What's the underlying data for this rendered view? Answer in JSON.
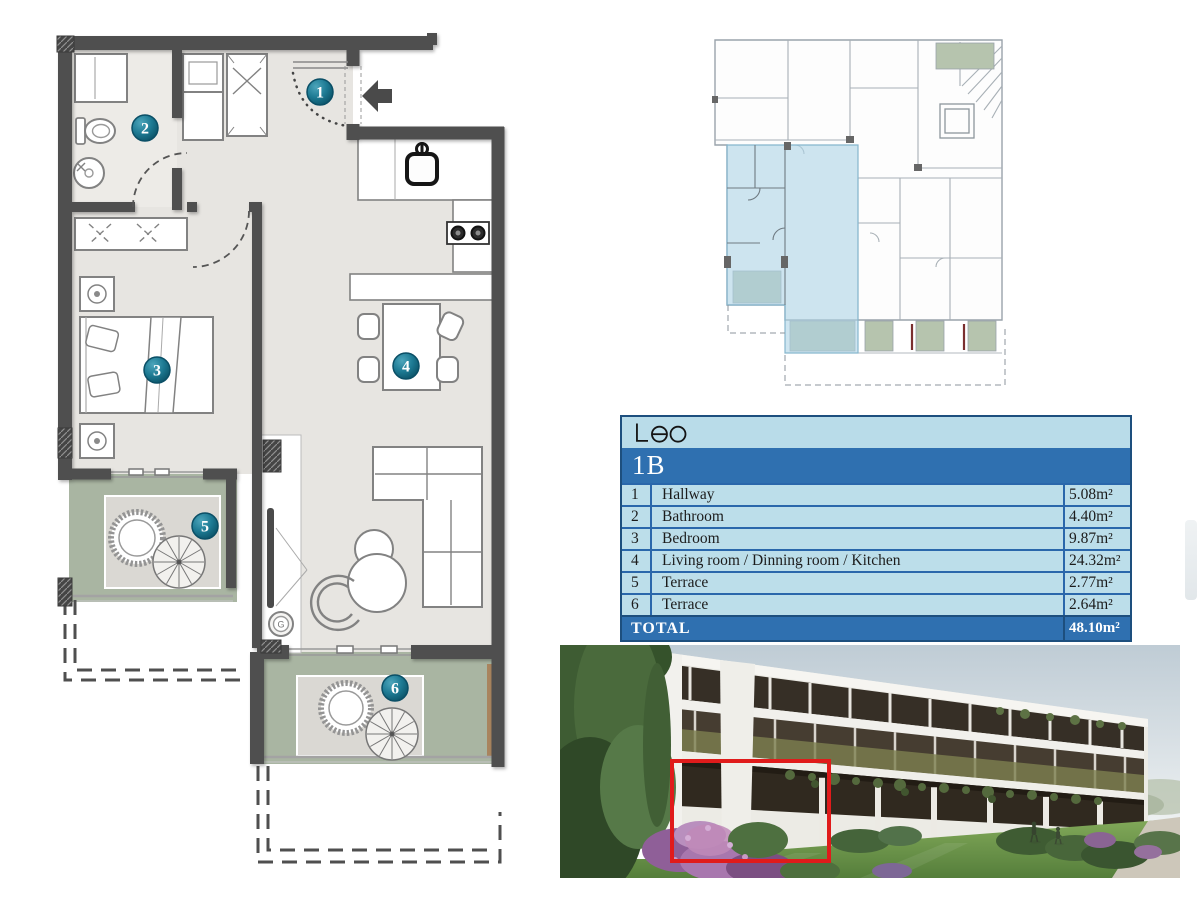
{
  "logo": {
    "text": "Leo"
  },
  "unit": {
    "label": "1B"
  },
  "table": {
    "rows": [
      {
        "num": "1",
        "name": "Hallway",
        "area": "5.08m²"
      },
      {
        "num": "2",
        "name": "Bathroom",
        "area": "4.40m²"
      },
      {
        "num": "3",
        "name": "Bedroom",
        "area": "9.87m²"
      },
      {
        "num": "4",
        "name": "Living room / Dinning room / Kitchen",
        "area": "24.32m²"
      },
      {
        "num": "5",
        "name": "Terrace",
        "area": "2.77m²"
      },
      {
        "num": "6",
        "name": "Terrace",
        "area": "2.64m²"
      }
    ],
    "total_label": "TOTAL",
    "total_area": "48.10m²"
  },
  "floorplan": {
    "badges": [
      "1",
      "2",
      "3",
      "4",
      "5",
      "6"
    ],
    "boiler_label": "G"
  },
  "colors": {
    "table_band": "#2f70b0",
    "table_cell": "#bcdeea",
    "table_border": "#2a67ab",
    "wall": "#4f4f4f",
    "terrace_green": "#a9b5a2",
    "badge_teal": "#17718a",
    "keyplan_highlight": "#aed4e6",
    "photo_highlight_box": "#e01b1b"
  }
}
